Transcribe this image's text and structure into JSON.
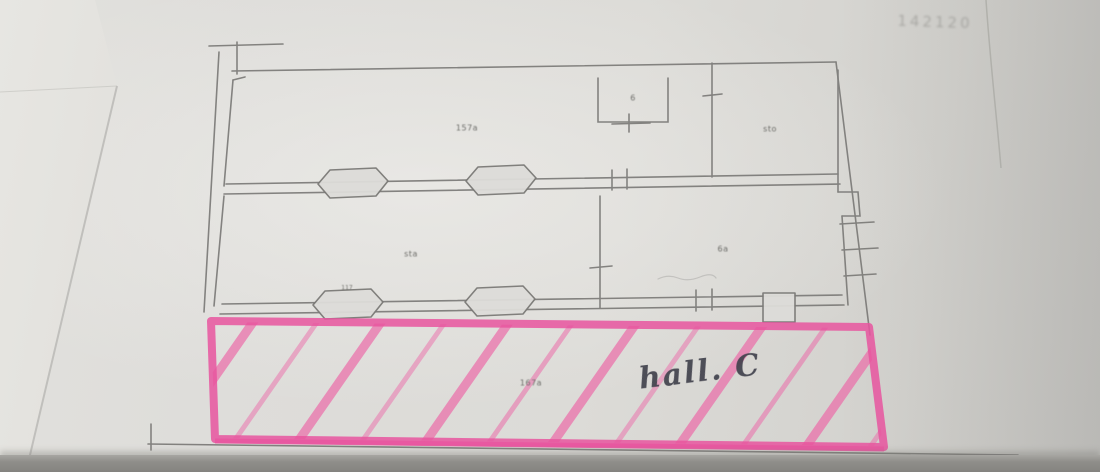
{
  "photo": {
    "corner_note": "142120",
    "colors": {
      "paper": "#dddcd8",
      "pencil": "#7b7a77",
      "highlighter_pink": "#e8559f",
      "handwriting_ink": "#3e3f4a"
    }
  },
  "floor_plan": {
    "rooms": {
      "upper_left_label": "157a",
      "top_square_label": "6",
      "upper_right_label": "sto",
      "mid_left_label": "sta",
      "mid_right_label": "6a",
      "wall_note_label": "117",
      "hall_small_label": "167a"
    },
    "hall": {
      "name": "hall. C"
    }
  }
}
